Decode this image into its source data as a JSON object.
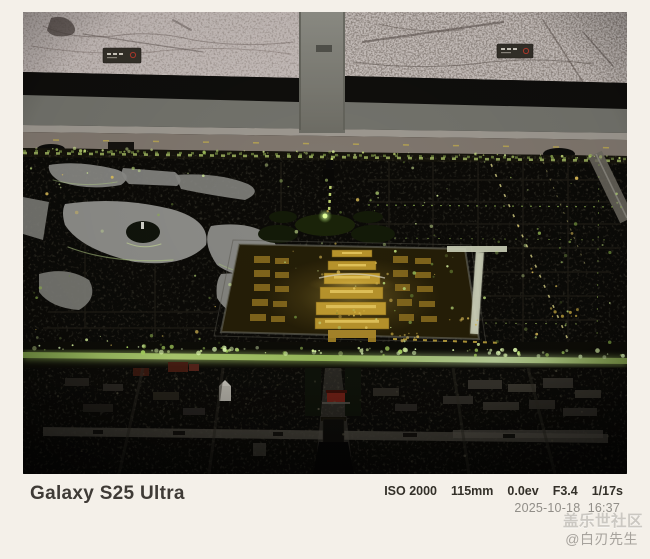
{
  "frame": {
    "device_label": "Galaxy S25 Ultra",
    "exif": {
      "iso": "ISO 2000",
      "focal_length": "115mm",
      "exposure_value": "0.0ev",
      "aperture": "F3.4",
      "shutter_speed": "1/17s"
    },
    "datetime": "2025-10-18  16:37",
    "community_watermark": "盖乐世社区",
    "username_watermark": "@白刃先生"
  },
  "photo": {
    "palette": {
      "card_background": "#f4f0e9",
      "map_paper": "#c7beba",
      "wall_gray": "#73736c",
      "model_base": "#0b0a07",
      "lake_gray": "#8d8d89",
      "tree_light_green": "#b8d877",
      "bright_green": "#d6f09a",
      "palace_gold": "#b9952c",
      "glow_gold": "#e3c45a",
      "avenue_glow": "#c2d9a0"
    }
  }
}
